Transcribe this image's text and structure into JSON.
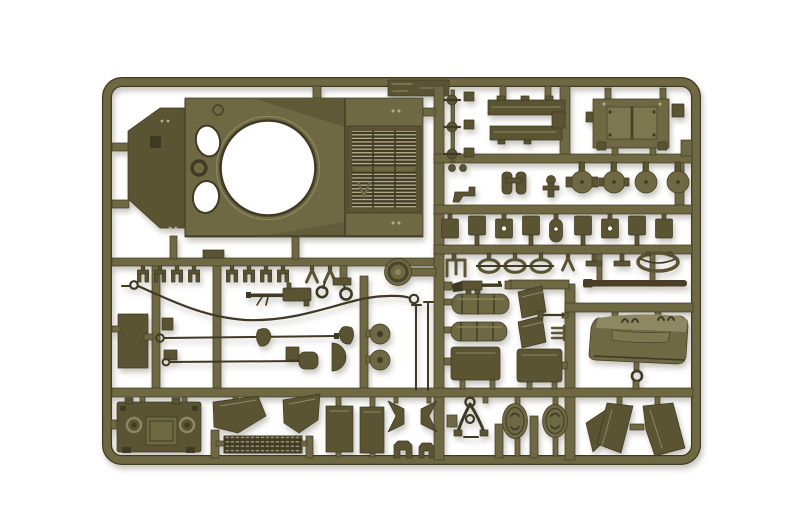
{
  "meta": {
    "type": "photograph",
    "subject": "Injection-molded olive drab plastic model kit sprue (parts tree) for a Sherman-type tank kit, photographed on a plain white background",
    "aria_label": "Olive green model kit sprue with tank parts: upper hull with turret ring and engine grille, hatches, fenders, tools, wheels and stowage parts"
  },
  "colors": {
    "background": "#ffffff",
    "plastic_mid": "#6f6943",
    "plastic_mid2": "#7d7750",
    "plastic_dark": "#5a5433",
    "plastic_deep": "#3f3a24",
    "plastic_light": "#8e8862",
    "plastic_pale": "#b7b08d",
    "barrel_brown": "#4a3e28"
  },
  "sprue": {
    "frame_shape": "rounded rectangle runner frame with internal grid of runners",
    "parts": [
      {
        "name": "upper-hull",
        "desc": "tank upper hull deck with open turret ring, two crew hatch openings and engine air grille"
      },
      {
        "name": "molded-id-tab",
        "desc": "ribbed identification tab on top runner"
      },
      {
        "name": "engine-access-panel",
        "desc": "rectangular twin-door engine hatch panel"
      },
      {
        "name": "sponson-strip-1",
        "desc": "long flat hull sponson strip"
      },
      {
        "name": "sponson-strip-2",
        "desc": "long flat hull sponson strip"
      },
      {
        "name": "periscope-knobs",
        "desc": "column of three small periscope parts"
      },
      {
        "name": "binocular-periscope",
        "desc": "twin periscope part"
      },
      {
        "name": "hatch-discs",
        "desc": "four round hatch lids, two with hinge plates"
      },
      {
        "name": "suspension-brackets-row",
        "desc": "row of nine small suspension bracket plates"
      },
      {
        "name": "shackle-row",
        "desc": "tow shackles, forks and oval ring parts"
      },
      {
        "name": "gun-barrel",
        "desc": "dark straight gun barrel rod"
      },
      {
        "name": "track-clip-row",
        "desc": "row of small track end connector clips"
      },
      {
        "name": "idler-wheel",
        "desc": "single round idler wheel"
      },
      {
        "name": "tow-cable",
        "desc": "long curved tow cable with eyelet ends"
      },
      {
        "name": "machine-gun",
        "desc": "pintle machine gun"
      },
      {
        "name": "thompson-smg",
        "desc": "small Thompson submachine gun"
      },
      {
        "name": "stowage-rolls",
        "desc": "two ribbed bedroll/stowage cylinders"
      },
      {
        "name": "tool-rods",
        "desc": "tow rods with eyelets, shovel and D-shaped bracket"
      },
      {
        "name": "return-rollers",
        "desc": "two small stacked road rollers"
      },
      {
        "name": "antenna-rods",
        "desc": "two thin antenna rods"
      },
      {
        "name": "side-panel",
        "desc": "flat rectangular hull side panel"
      },
      {
        "name": "rear-plate",
        "desc": "hull rear plate with hatch and lifting eyes"
      },
      {
        "name": "fender-left",
        "desc": "angled front fender plate"
      },
      {
        "name": "fender-right",
        "desc": "angled front fender plate"
      },
      {
        "name": "louver-grille",
        "desc": "slatted louver grille strip"
      },
      {
        "name": "skirt-panels",
        "desc": "two tall rectangular skirt panels"
      },
      {
        "name": "chevron-wedges",
        "desc": "pair of facing wedge-shaped brackets"
      },
      {
        "name": "small-staples",
        "desc": "two small bridge clamp parts"
      },
      {
        "name": "travel-lock",
        "desc": "A-frame gun travel lock"
      },
      {
        "name": "oval-hatches",
        "desc": "two oval hatch lids"
      },
      {
        "name": "mudguard-fins",
        "desc": "three angular mudguard plates"
      },
      {
        "name": "stowage-bin",
        "desc": "curved rear stowage bin with footman loops"
      },
      {
        "name": "towing-hook",
        "desc": "small ring towing hook"
      },
      {
        "name": "sand-shield-sections",
        "desc": "two rectangular sand shield panels"
      },
      {
        "name": "angled-plates",
        "desc": "two small angled plates"
      }
    ]
  }
}
